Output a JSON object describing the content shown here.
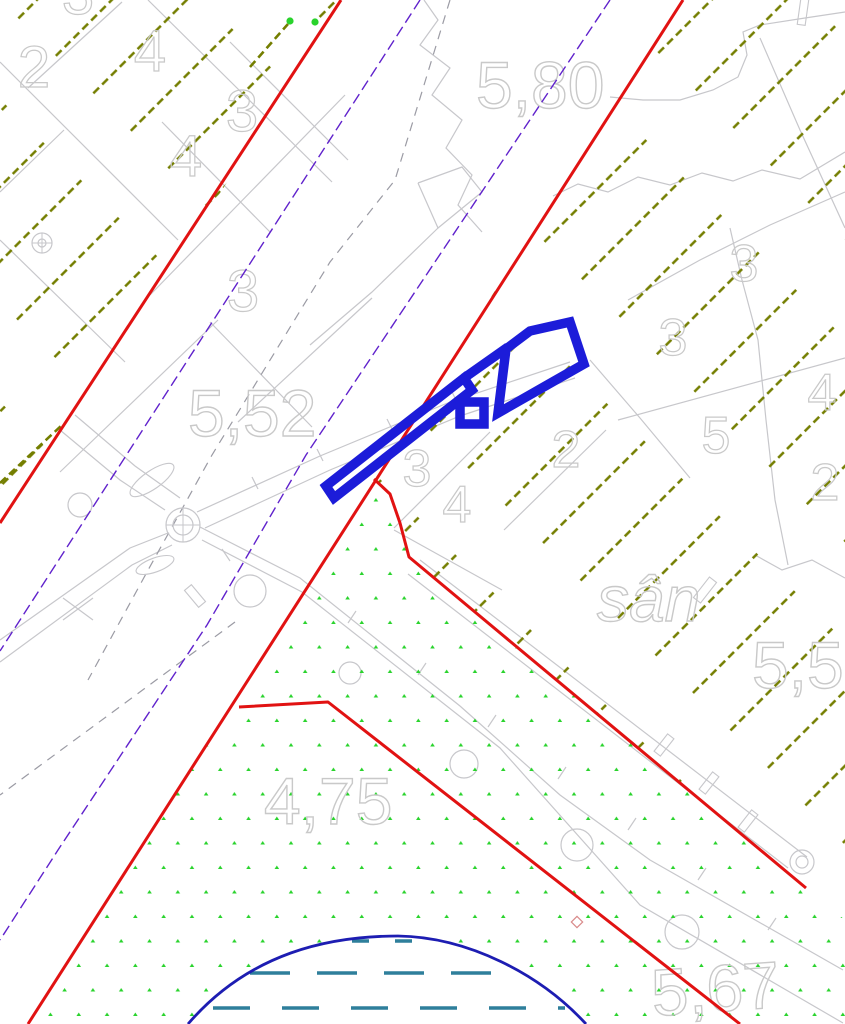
{
  "map": {
    "canvas": {
      "w": 845,
      "h": 1024,
      "bg": "#ffffff"
    },
    "colors": {
      "gray": "#c7c7cb",
      "gray_dark": "#9b9ba4",
      "label": "#c9c9c9",
      "olive": "#747e00",
      "green_dot": "#29d32c",
      "red": "#e11212",
      "purple": "#6022cc",
      "blue_building": "#1c1cd9",
      "water_arc": "#1d1db2",
      "water_dash": "#2e7f9b"
    },
    "labels": [
      {
        "text": "2",
        "x": 34,
        "y": 87,
        "size": 58,
        "anchor": "middle"
      },
      {
        "text": "4",
        "x": 150,
        "y": 71,
        "size": 58,
        "anchor": "middle"
      },
      {
        "text": "3",
        "x": 78,
        "y": 14,
        "size": 58,
        "anchor": "middle"
      },
      {
        "text": "3",
        "x": 242,
        "y": 131,
        "size": 58,
        "anchor": "middle"
      },
      {
        "text": "4",
        "x": 186,
        "y": 176,
        "size": 58,
        "anchor": "middle"
      },
      {
        "text": "3",
        "x": 243,
        "y": 311,
        "size": 58,
        "anchor": "middle"
      },
      {
        "text": "5,80",
        "x": 476,
        "y": 108,
        "size": 66,
        "anchor": "start"
      },
      {
        "text": "5,52",
        "x": 188,
        "y": 436,
        "size": 66,
        "anchor": "start"
      },
      {
        "text": "3",
        "x": 417,
        "y": 486,
        "size": 52,
        "anchor": "middle"
      },
      {
        "text": "4",
        "x": 457,
        "y": 522,
        "size": 52,
        "anchor": "middle"
      },
      {
        "text": "2",
        "x": 566,
        "y": 467,
        "size": 52,
        "anchor": "middle"
      },
      {
        "text": "3",
        "x": 744,
        "y": 281,
        "size": 52,
        "anchor": "middle"
      },
      {
        "text": "3",
        "x": 673,
        "y": 355,
        "size": 52,
        "anchor": "middle"
      },
      {
        "text": "5",
        "x": 716,
        "y": 453,
        "size": 52,
        "anchor": "middle"
      },
      {
        "text": "4",
        "x": 822,
        "y": 410,
        "size": 52,
        "anchor": "middle"
      },
      {
        "text": "2",
        "x": 825,
        "y": 500,
        "size": 52,
        "anchor": "middle"
      },
      {
        "text": "sân",
        "x": 597,
        "y": 621,
        "size": 64,
        "anchor": "start",
        "italic": true
      },
      {
        "text": "5,5",
        "x": 752,
        "y": 688,
        "size": 66,
        "anchor": "start"
      },
      {
        "text": "4,75",
        "x": 264,
        "y": 824,
        "size": 66,
        "anchor": "start"
      },
      {
        "text": "5,67",
        "x": 653,
        "y": 1016,
        "size": 66,
        "anchor": "start",
        "rotate": -4
      }
    ],
    "gray": {
      "polylines": [
        [
          [
            148,
            0
          ],
          [
            332,
            182
          ]
        ],
        [
          [
            0,
            62
          ],
          [
            178,
            240
          ]
        ],
        [
          [
            0,
            240
          ],
          [
            125,
            362
          ]
        ],
        [
          [
            28,
            88
          ],
          [
            122,
            2
          ]
        ],
        [
          [
            0,
            192
          ],
          [
            64,
            130
          ]
        ],
        [
          [
            345,
            95
          ],
          [
            150,
            295
          ]
        ],
        [
          [
            60,
            472
          ],
          [
            218,
            320
          ]
        ],
        [
          [
            230,
            42
          ],
          [
            348,
            160
          ]
        ],
        [
          [
            162,
            122
          ],
          [
            270,
            232
          ]
        ],
        [
          [
            210,
            322
          ],
          [
            312,
            427
          ]
        ],
        [
          [
            424,
            0
          ],
          [
            438,
            20
          ],
          [
            420,
            45
          ],
          [
            450,
            68
          ],
          [
            432,
            95
          ],
          [
            462,
            120
          ],
          [
            446,
            148
          ],
          [
            472,
            175
          ],
          [
            458,
            205
          ],
          [
            482,
            232
          ]
        ],
        [
          [
            553,
            196
          ],
          [
            578,
            184
          ],
          [
            608,
            192
          ],
          [
            638,
            177
          ],
          [
            670,
            185
          ],
          [
            702,
            173
          ],
          [
            733,
            181
          ],
          [
            762,
            170
          ],
          [
            800,
            179
          ],
          [
            845,
            152
          ]
        ],
        [
          [
            610,
            97
          ],
          [
            643,
            100
          ],
          [
            680,
            100
          ],
          [
            713,
            90
          ],
          [
            738,
            77
          ],
          [
            747,
            55
          ],
          [
            743,
            32
          ],
          [
            760,
            25
          ],
          [
            805,
            18
          ],
          [
            845,
            12
          ]
        ],
        [
          [
            760,
            38
          ],
          [
            800,
            130
          ],
          [
            845,
            228
          ]
        ],
        [
          [
            618,
            420
          ],
          [
            845,
            358
          ]
        ],
        [
          [
            730,
            228
          ],
          [
            742,
            280
          ],
          [
            758,
            340
          ],
          [
            766,
            420
          ],
          [
            775,
            500
          ],
          [
            788,
            565
          ]
        ],
        [
          [
            628,
            300
          ],
          [
            700,
            260
          ],
          [
            770,
            225
          ],
          [
            845,
            192
          ]
        ],
        [
          [
            755,
            555
          ],
          [
            782,
            570
          ],
          [
            812,
            560
          ],
          [
            845,
            578
          ]
        ],
        [
          [
            197,
            512
          ],
          [
            320,
            456
          ],
          [
            450,
            402
          ],
          [
            570,
            362
          ]
        ],
        [
          [
            205,
            528
          ],
          [
            330,
            470
          ],
          [
            460,
            416
          ],
          [
            575,
            378
          ]
        ],
        [
          [
            420,
            560
          ],
          [
            807,
            857
          ]
        ],
        [
          [
            408,
            574
          ],
          [
            788,
            868
          ]
        ],
        [
          [
            200,
            527
          ],
          [
            300,
            578
          ],
          [
            460,
            706
          ],
          [
            560,
            795
          ],
          [
            650,
            860
          ],
          [
            843,
            970
          ]
        ],
        [
          [
            202,
            540
          ],
          [
            302,
            592
          ],
          [
            500,
            748
          ],
          [
            640,
            905
          ],
          [
            843,
            1023
          ]
        ],
        [
          [
            0,
            640
          ],
          [
            130,
            548
          ],
          [
            168,
            533
          ]
        ],
        [
          [
            0,
            662
          ],
          [
            132,
            565
          ],
          [
            172,
            545
          ]
        ],
        [
          [
            60,
            430
          ],
          [
            120,
            480
          ],
          [
            165,
            510
          ]
        ],
        [
          [
            75,
            415
          ],
          [
            135,
            466
          ],
          [
            180,
            498
          ]
        ],
        [
          [
            63,
            598
          ],
          [
            93,
            620
          ]
        ],
        [
          [
            63,
            620
          ],
          [
            93,
            598
          ]
        ],
        [
          [
            590,
            360
          ],
          [
            640,
            418
          ],
          [
            690,
            478
          ]
        ],
        [
          [
            418,
            183
          ],
          [
            462,
            167
          ],
          [
            482,
            192
          ],
          [
            438,
            228
          ],
          [
            418,
            183
          ]
        ],
        [
          [
            438,
            228
          ],
          [
            372,
            292
          ],
          [
            310,
            345
          ]
        ],
        [
          [
            372,
            298
          ],
          [
            238,
            422
          ]
        ],
        [
          [
            490,
            432
          ],
          [
            394,
            528
          ]
        ],
        [
          [
            394,
            530
          ],
          [
            502,
            590
          ]
        ],
        [
          [
            606,
            430
          ],
          [
            504,
            530
          ]
        ]
      ],
      "dashed": [
        [
          [
            450,
            0
          ],
          [
            395,
            180
          ],
          [
            330,
            262
          ],
          [
            212,
            455
          ],
          [
            147,
            572
          ],
          [
            88,
            680
          ]
        ],
        [
          [
            235,
            622
          ],
          [
            0,
            795
          ]
        ]
      ],
      "circles": [
        {
          "cx": 42,
          "cy": 243,
          "r": 10,
          "r2": 4,
          "cross": true
        },
        {
          "cx": 183,
          "cy": 525,
          "r": 17,
          "r2": 10,
          "cross": true
        },
        {
          "cx": 80,
          "cy": 505,
          "r": 12
        },
        {
          "cx": 250,
          "cy": 591,
          "r": 16
        },
        {
          "cx": 350,
          "cy": 673,
          "r": 11
        },
        {
          "cx": 464,
          "cy": 764,
          "r": 14
        },
        {
          "cx": 577,
          "cy": 845,
          "r": 16
        },
        {
          "cx": 682,
          "cy": 932,
          "r": 17
        },
        {
          "cx": 802,
          "cy": 862,
          "r": 12,
          "r2": 6
        }
      ],
      "ticks": [
        [
          348,
          623,
          356,
          611
        ],
        [
          418,
          675,
          426,
          663
        ],
        [
          488,
          727,
          496,
          715
        ],
        [
          558,
          779,
          566,
          767
        ],
        [
          628,
          830,
          636,
          818
        ],
        [
          698,
          880,
          706,
          868
        ],
        [
          768,
          930,
          776,
          918
        ],
        [
          252,
          477,
          258,
          489
        ],
        [
          317,
          449,
          323,
          461
        ],
        [
          387,
          419,
          393,
          431
        ],
        [
          452,
          392,
          458,
          404
        ],
        [
          222,
          549,
          230,
          561
        ]
      ],
      "rects": [
        {
          "cx": 195,
          "cy": 596,
          "w": 9,
          "h": 22,
          "rot": -40
        },
        {
          "cx": 664,
          "cy": 745,
          "w": 8,
          "h": 22,
          "rot": 38
        },
        {
          "cx": 709,
          "cy": 783,
          "w": 8,
          "h": 22,
          "rot": 38
        },
        {
          "cx": 748,
          "cy": 821,
          "w": 8,
          "h": 22,
          "rot": 38
        },
        {
          "cx": 705,
          "cy": 590,
          "w": 9,
          "h": 26,
          "rot": 38
        },
        {
          "cx": 803,
          "cy": 12,
          "w": 8,
          "h": 26,
          "rot": 8
        }
      ],
      "blobs": [
        {
          "cx": 152,
          "cy": 480,
          "rx": 26,
          "ry": 9,
          "rot": -35
        },
        {
          "cx": 155,
          "cy": 565,
          "rx": 20,
          "ry": 7,
          "rot": -20
        }
      ]
    },
    "olive_hatch": {
      "regions": [
        [
          [
            0,
            0
          ],
          [
            345,
            0
          ],
          [
            0,
            533
          ]
        ],
        [
          [
            683,
            0
          ],
          [
            845,
            0
          ],
          [
            845,
            918
          ],
          [
            806,
            888
          ],
          [
            409,
            557
          ],
          [
            400,
            522
          ],
          [
            390,
            495
          ],
          [
            374,
            478
          ]
        ]
      ],
      "segments": [
        [
          250,
          67,
          288,
          24
        ],
        [
          0,
          483,
          62,
          425
        ]
      ]
    },
    "green_dots": {
      "region": [
        [
          374,
          480
        ],
        [
          392,
          498
        ],
        [
          402,
          528
        ],
        [
          409,
          557
        ],
        [
          806,
          888
        ],
        [
          845,
          920
        ],
        [
          845,
          1024
        ],
        [
          28,
          1024
        ]
      ]
    },
    "water": {
      "fill_path": "M188,1024 C250,952 330,936 398,936 C468,937 540,974 586,1024 Z",
      "arc_path": "M188,1024 C250,952 330,936 398,936 C468,937 540,974 586,1024",
      "dash_rows": [
        {
          "y": 941,
          "x1": 352,
          "x2": 432,
          "dash": "17 26"
        },
        {
          "y": 973,
          "x1": 250,
          "x2": 492,
          "dash": "40 27"
        },
        {
          "y": 1008,
          "x1": 213,
          "x2": 565,
          "dash": "37 32"
        }
      ]
    },
    "purple_lines": [
      [
        [
          610,
          0
        ],
        [
          306,
          455
        ],
        [
          207,
          625
        ],
        [
          58,
          850
        ],
        [
          0,
          940
        ]
      ],
      [
        [
          420,
          0
        ],
        [
          0,
          651
        ]
      ]
    ],
    "red_lines": [
      [
        [
          341,
          0
        ],
        [
          0,
          523
        ]
      ],
      [
        [
          683,
          0
        ],
        [
          28,
          1024
        ]
      ],
      [
        [
          374,
          479
        ],
        [
          390,
          494
        ],
        [
          400,
          523
        ],
        [
          409,
          557
        ],
        [
          806,
          888
        ]
      ],
      [
        [
          239,
          707
        ],
        [
          328,
          702
        ],
        [
          740,
          1024
        ]
      ]
    ],
    "blue_building": {
      "paths": [
        {
          "name": "bar",
          "pts": [
            [
              326,
              486
            ],
            [
              464,
              378
            ],
            [
              472,
              390
            ],
            [
              334,
              498
            ]
          ],
          "closed": true
        },
        {
          "name": "head",
          "pts": [
            [
              506,
              349
            ],
            [
              530,
              331
            ],
            [
              570,
              322
            ],
            [
              584,
              364
            ],
            [
              498,
              413
            ]
          ],
          "closed": true
        },
        {
          "name": "connector",
          "pts": [
            [
              464,
              378
            ],
            [
              508,
              347
            ]
          ],
          "closed": false
        },
        {
          "name": "tab",
          "pts": [
            [
              460,
              402
            ],
            [
              484,
              402
            ],
            [
              484,
              424
            ],
            [
              460,
              424
            ]
          ],
          "closed": true
        }
      ],
      "stroke_width": 9.5
    },
    "markers": {
      "green_points": [
        [
          290,
          21
        ],
        [
          315,
          22
        ]
      ],
      "diamond": {
        "cx": 577,
        "cy": 922,
        "s": 8
      }
    }
  }
}
